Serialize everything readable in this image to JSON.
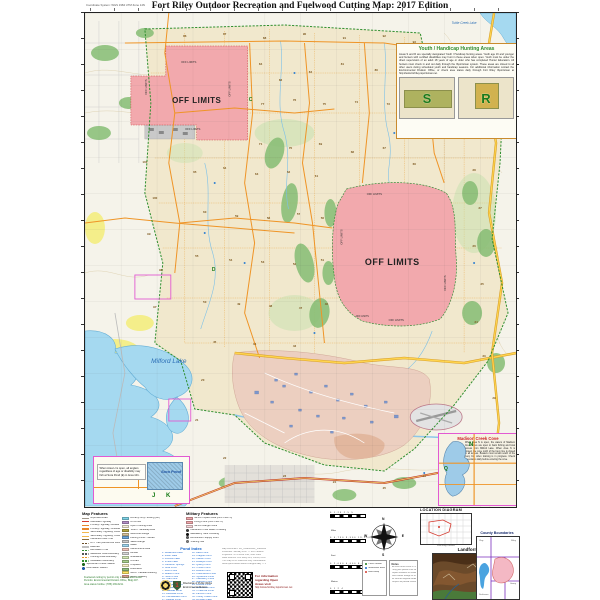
{
  "header": {
    "title": "Fort Riley Outdoor Recreation and Fuelwood Cutting Map: 2017 Edition",
    "coordinate_note": "Coordinate System: WGS 1984 UTM Zone 14N"
  },
  "colors": {
    "off_limits": "#f2a9ad",
    "water": "#a5d9f0",
    "installation_boundary": "#2f8f2f",
    "road": "#ef9426",
    "highway": "#ffd54f",
    "cantonment": "#eccfc0",
    "forest": "#86bd74",
    "cropland": "#f4ee8a",
    "inset_border": "#e25ad2"
  },
  "map": {
    "labels": [
      {
        "text": "OFF LIMITS",
        "x": 112,
        "y": 90,
        "s": 8,
        "w": "bold",
        "c": "#222"
      },
      {
        "text": "OFF LIMITS",
        "x": 104,
        "y": 50,
        "s": 2.8,
        "c": "#333"
      },
      {
        "text": "OFF LIMITS",
        "x": 108,
        "y": 117,
        "s": 2.8,
        "c": "#333"
      },
      {
        "text": "OFF LIMITS",
        "x": 62,
        "y": 74,
        "s": 2.8,
        "c": "#333",
        "r": -90
      },
      {
        "text": "OFF LIMITS",
        "x": 146,
        "y": 76,
        "s": 2.8,
        "c": "#333",
        "r": -90
      },
      {
        "text": "OFF LIMITS",
        "x": 308,
        "y": 252,
        "s": 9,
        "w": "bold",
        "c": "#222"
      },
      {
        "text": "OFF LIMITS",
        "x": 290,
        "y": 182,
        "s": 2.8,
        "c": "#333"
      },
      {
        "text": "OFF LIMITS",
        "x": 312,
        "y": 308,
        "s": 2.8,
        "c": "#333"
      },
      {
        "text": "OFF LIMITS",
        "x": 258,
        "y": 224,
        "s": 2.8,
        "c": "#333",
        "r": -90
      },
      {
        "text": "OFF LIMITS",
        "x": 362,
        "y": 270,
        "s": 2.8,
        "c": "#333",
        "r": -90
      },
      {
        "text": "OFF LIMITS",
        "x": 278,
        "y": 304,
        "s": 2.4,
        "c": "#333"
      },
      {
        "text": "Milford Lake",
        "x": 84,
        "y": 350,
        "s": 6.5,
        "c": "#2a6db5",
        "i": 1
      },
      {
        "text": "Tuttle Creek Lake",
        "x": 380,
        "y": 11,
        "s": 3.2,
        "c": "#2a6db5",
        "i": 1
      }
    ],
    "letters": [
      {
        "t": "C",
        "x": 166,
        "y": 88
      },
      {
        "t": "D",
        "x": 129,
        "y": 258
      }
    ],
    "area_numbers": [
      [
        "86",
        100,
        24
      ],
      [
        "87",
        140,
        22
      ],
      [
        "88",
        180,
        26
      ],
      [
        "90",
        220,
        22
      ],
      [
        "91",
        260,
        26
      ],
      [
        "92",
        300,
        24
      ],
      [
        "93",
        330,
        30
      ],
      [
        "84",
        176,
        52
      ],
      [
        "83",
        196,
        68
      ],
      [
        "82",
        226,
        60
      ],
      [
        "81",
        258,
        52
      ],
      [
        "80",
        292,
        58
      ],
      [
        "79",
        318,
        54
      ],
      [
        "78",
        344,
        50
      ],
      [
        "77",
        178,
        92
      ],
      [
        "76",
        210,
        88
      ],
      [
        "75",
        240,
        92
      ],
      [
        "74",
        272,
        90
      ],
      [
        "73",
        304,
        92
      ],
      [
        "72",
        334,
        96
      ],
      [
        "71",
        176,
        132
      ],
      [
        "70",
        206,
        136
      ],
      [
        "69",
        236,
        132
      ],
      [
        "68",
        268,
        140
      ],
      [
        "67",
        300,
        136
      ],
      [
        "66",
        330,
        152
      ],
      [
        "101",
        60,
        150
      ],
      [
        "100",
        70,
        186
      ],
      [
        "99",
        64,
        222
      ],
      [
        "98",
        76,
        258
      ],
      [
        "97",
        70,
        295
      ],
      [
        "65",
        110,
        160
      ],
      [
        "64",
        140,
        156
      ],
      [
        "63",
        172,
        162
      ],
      [
        "62",
        204,
        160
      ],
      [
        "61",
        232,
        164
      ],
      [
        "60",
        120,
        200
      ],
      [
        "59",
        152,
        204
      ],
      [
        "58",
        184,
        206
      ],
      [
        "57",
        214,
        202
      ],
      [
        "56",
        238,
        206
      ],
      [
        "55",
        112,
        244
      ],
      [
        "54",
        146,
        248
      ],
      [
        "53",
        178,
        250
      ],
      [
        "52",
        210,
        252
      ],
      [
        "51",
        238,
        248
      ],
      [
        "50",
        120,
        290
      ],
      [
        "49",
        154,
        292
      ],
      [
        "48",
        186,
        294
      ],
      [
        "47",
        216,
        296
      ],
      [
        "46",
        242,
        292
      ],
      [
        "45",
        130,
        330
      ],
      [
        "44",
        170,
        332
      ],
      [
        "43",
        210,
        334
      ],
      [
        "40",
        392,
        84
      ],
      [
        "39",
        398,
        120
      ],
      [
        "38",
        390,
        158
      ],
      [
        "37",
        396,
        196
      ],
      [
        "36",
        390,
        234
      ],
      [
        "35",
        398,
        272
      ],
      [
        "34",
        392,
        310
      ],
      [
        "33",
        400,
        344
      ],
      [
        "20",
        118,
        368
      ],
      [
        "21",
        112,
        408
      ],
      [
        "22",
        140,
        446
      ],
      [
        "23",
        200,
        464
      ],
      [
        "24",
        250,
        470
      ],
      [
        "25",
        300,
        476
      ],
      [
        "26",
        340,
        464
      ],
      [
        "27",
        378,
        448
      ],
      [
        "28",
        398,
        422
      ],
      [
        "29",
        410,
        386
      ]
    ]
  },
  "insets": {
    "youth": {
      "title": "Youth / Handicap Hunting Areas",
      "body": "Areas S and R are specially designated Youth / Handicap hunting areas. Youth age 16 and younger and hunters with certified disabilities may hunt in these areas when open. Youth must be under the direct supervision of an adult 18 years of age or older who has completed Hunter Education. All hunters must check in and out daily through the iSportsman system. These areas are closed to all other users during scheduled youth and handicap seasons. For additional information contact the Environmental Division Office, or check area status daily through Fort Riley iSportsman at http://www.fortriley.isportsman.net.",
      "area_labels": [
        "S",
        "R"
      ]
    },
    "madison": {
      "title": "Madison Creek Cove",
      "body": "When Area N is open, the waters of Madison Creek Cove are open to bank fishing and boat access from Milford Lake. When Area N is closed, the cove north of the buoy line is closed to all access. Boaters must remain south of the buoy line when training is in progress. Check area status daily before entering the cove.",
      "markers": [
        "N",
        "Q"
      ]
    },
    "sora": {
      "body": "When Area H is open, all anglers regardless of age or disability may fish at Sora Pond (E) in Area 101.",
      "pond_label": "Sora Pond",
      "letters": [
        "J",
        "K"
      ]
    }
  },
  "legend": {
    "map_features": {
      "title": "Map Features",
      "left": [
        {
          "label": "Improved Road",
          "c": "#9e968a",
          "t": "line"
        },
        {
          "label": "Interstate Highway",
          "c": "#d43a2f",
          "t": "line"
        },
        {
          "label": "Primary Highway, Divided",
          "c": "#e8862c",
          "t": "line"
        },
        {
          "label": "Primary Highway, Undivided",
          "c": "#e8862c",
          "t": "line"
        },
        {
          "label": "Secondary Highway, Divided",
          "c": "#f2b84c",
          "t": "line"
        },
        {
          "label": "Secondary Highway, Undivided",
          "c": "#f2b84c",
          "t": "line"
        },
        {
          "label": "Hardened Tank Trail",
          "c": "#8a6d3b",
          "t": "line"
        },
        {
          "label": "ATV Trail (Authorized Routes Only)",
          "c": "#6b4f2a",
          "t": "dash"
        },
        {
          "label": "Railroad",
          "c": "#333333",
          "t": "rail"
        },
        {
          "label": "Recreation Trail",
          "c": "#2e8b2e",
          "t": "dash"
        },
        {
          "label": "Maneuver Area Boundary",
          "c": "#555555",
          "t": "dash"
        },
        {
          "label": "Hunting Area Boundary",
          "c": "#e8941f",
          "t": "dash"
        },
        {
          "label": "Installation Boundary",
          "c": "#2f8f2f",
          "t": "dash"
        },
        {
          "label": "Sportsman Check Station",
          "c": "#1a7a1a",
          "t": "dot"
        },
        {
          "label": "Information Station",
          "c": "#1a66cc",
          "t": "dot"
        }
      ],
      "right": [
        {
          "label": "Archery Only Hunting (AO)",
          "c": "#7fd4e8",
          "t": "fill"
        },
        {
          "label": "Off Limits",
          "c": "#b58fc6",
          "t": "fill"
        },
        {
          "label": "Open Hunting Area",
          "c": "#f5edd8",
          "t": "fill"
        },
        {
          "label": "Youth / Handicap Area",
          "c": "#b5a642",
          "t": "fill"
        },
        {
          "label": "Multi-Use Range",
          "c": "#d9c49a",
          "t": "fill"
        },
        {
          "label": "Fishing Pond / Stream",
          "c": "#6fa8dc",
          "t": "fill"
        },
        {
          "label": "Skeet Range",
          "c": "#c9c9c9",
          "t": "fill"
        },
        {
          "label": "Water",
          "c": "#9fd5ee",
          "t": "fill"
        },
        {
          "label": "Cantonment Area",
          "c": "#f2c4bb",
          "t": "fill"
        },
        {
          "label": "Airfield",
          "c": "#d8d8d8",
          "t": "fill"
        },
        {
          "label": "Grassland",
          "c": "#d3e8b4",
          "t": "fill"
        },
        {
          "label": "Orchard",
          "c": "#a8d08d",
          "t": "fill"
        },
        {
          "label": "Cropland",
          "c": "#f7f2c5",
          "t": "fill"
        },
        {
          "label": "Brushland",
          "c": "#8fbf7f",
          "t": "fill"
        },
        {
          "label": "MOUT Facade Building",
          "c": "#ffe766",
          "t": "fill"
        },
        {
          "label": "MOUT Building",
          "c": "#f4a6a0",
          "t": "fill"
        }
      ]
    },
    "military_features": {
      "title": "Military Features",
      "items": [
        {
          "label": "MPRC Impact Area (OFF LIMITS)",
          "c": "#f2a9ad",
          "t": "fill"
        },
        {
          "label": "Firing Point (OFF LIMITS)",
          "c": "#f2a9ad",
          "t": "fill"
        },
        {
          "label": "MPRC Danger Zone",
          "c": "#f8d7da",
          "t": "fill"
        },
        {
          "label": "Hardened / Low Water Crossing",
          "c": "#444444",
          "t": "dot"
        },
        {
          "label": "Mandatory Tank Crossing",
          "c": "#111111",
          "t": "dot"
        },
        {
          "label": "Ammunition Supply Point",
          "c": "#666666",
          "t": "dot"
        },
        {
          "label": "Training Site",
          "c": "#888888",
          "t": "dot"
        }
      ]
    },
    "pond_index": {
      "title": "Pond Index",
      "items": [
        "Breakneck Lake",
        "Moon Lake",
        "Funston Lake",
        "Vinton Lake",
        "Cameron Springs",
        "Sora Pond",
        "Rush Pond",
        "Beaver Pond",
        "Heron Pond",
        "Teal Pond",
        "Mallard Pond",
        "Widgeon Pond",
        "Pintail Pond",
        "Gadwall Pond",
        "Redhead Pond",
        "Canvasback Pond",
        "Bluegill Pond",
        "Bass Pond",
        "Crappie Pond",
        "Catfish Pond",
        "Walleye Pond",
        "Quarry Pond",
        "Timber Pond",
        "Walnut Pond",
        "Cottonwood Pond",
        "Sycamore Pond",
        "Hackberry Pond",
        "Madison Pond",
        "Wildcat Pond",
        "Sevenmile Pond",
        "Threemile Pond",
        "Farnum Pond",
        "Honey Creek Pond",
        "Whiskey Lake"
      ]
    },
    "scalebars": [
      {
        "ticks": "0   1.25   2.5   5",
        "unit": "Miles"
      },
      {
        "ticks": "0   4,750   9,500   19,000",
        "unit": "Feet"
      },
      {
        "ticks": "0   2,000   4,000   8,000",
        "unit": "Meters"
      },
      {
        "ticks": "0   1   2   4",
        "unit": "Nautical Miles"
      }
    ],
    "compass": {
      "n": "N",
      "e": "E",
      "s": "S",
      "w": "W"
    },
    "location_diagram": {
      "title": "LOCATION DIAGRAM",
      "caption": "Fort Riley, Kansas"
    },
    "landform": {
      "title": "Landform"
    },
    "county_boundaries": {
      "title": "County Boundaries",
      "counties": [
        "Clay",
        "Riley",
        "Geary",
        "Dickinson"
      ]
    },
    "disclaimers": [
      "Map Document: FR_OutdoorRec_Fuelwood_2017.mxd",
      "Published: January 2017 — 2017 Edition",
      "Projection: UTM Zone 14N, NAD 1983",
      "Data Sources: Fort Riley GIS, USGS, KDOT",
      "This map is for reference only. Boundaries approximate.",
      "Area open/closed status changes daily — check first."
    ],
    "qr": {
      "lines": [
        "For information",
        "regarding Open",
        "Areas visit"
      ],
      "url": "http://www.fortriley.isportsman.net"
    },
    "symbols_box": [
      {
        "label": "Check Station",
        "c": "#1a7a1a"
      },
      {
        "label": "Information Board",
        "c": "#1a66cc"
      },
      {
        "label": "Boat Ramp",
        "c": "#d43a2f"
      }
    ],
    "notes_box": {
      "title": "Notes",
      "lines": [
        "All users must check in / out daily.",
        "Carry your permit at all times.",
        "Report violations to Game Wardens.",
        "Wear hunter orange as required.",
        "No vehicles beyond hardened roads.",
        "Respect all posted closures."
      ]
    },
    "credits": [
      "Fuelwood cutting by permit only in designated areas.",
      "Permits: Environmental Division Office, Bldg 407.",
      "Area status hotline: (785) 239-6211."
    ],
    "logo_caption": [
      "Directorate of Public Works",
      "Environmental Division"
    ]
  }
}
